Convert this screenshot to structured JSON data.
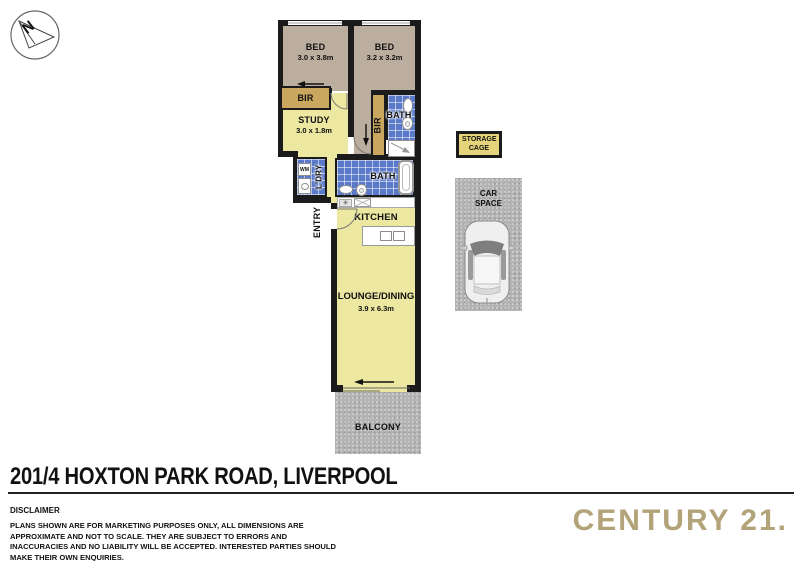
{
  "compass": {
    "north": "N"
  },
  "rooms": {
    "bed1": {
      "name": "BED",
      "dims": "3.0 x 3.8m"
    },
    "bed2": {
      "name": "BED",
      "dims": "3.2 x 3.2m"
    },
    "bir1": {
      "name": "BIR"
    },
    "bir2": {
      "name": "BIR"
    },
    "study": {
      "name": "STUDY",
      "dims": "3.0 x 1.8m"
    },
    "bath1": {
      "name": "BATH"
    },
    "bath2": {
      "name": "BATH"
    },
    "laundry": {
      "name": "L'DRY",
      "washing_machine": "WM"
    },
    "entry": {
      "name": "ENTRY"
    },
    "kitchen": {
      "name": "KITCHEN"
    },
    "lounge": {
      "name": "LOUNGE/DINING",
      "dims": "3.9 x 6.3m"
    },
    "balcony": {
      "name": "BALCONY"
    }
  },
  "external": {
    "storage_cage": "STORAGE CAGE",
    "car_space": "CAR SPACE"
  },
  "footer": {
    "address": "201/4 HOXTON PARK ROAD, LIVERPOOL",
    "disclaimer_heading": "DISCLAIMER",
    "disclaimer_body": "PLANS SHOWN ARE FOR MARKETING PURPOSES ONLY, ALL DIMENSIONS ARE APPROXIMATE AND NOT TO SCALE. THEY ARE SUBJECT TO ERRORS AND INACCURACIES AND NO LIABILITY WILL BE ACCEPTED. INTERESTED PARTIES SHOULD MAKE THEIR OWN ENQUIRIES.",
    "brand": "CENTURY 21."
  },
  "colors": {
    "walls": "#1b1b1b",
    "bedroom_floor": "#bcae9e",
    "living_floor": "#ece8a2",
    "wardrobe_gold": "#c9a75f",
    "bath_tile_blue": "#5b79c9",
    "outdoor_gray": "#b4b4b4",
    "storage_yellow": "#e5d479",
    "brand_gold": "#b3a379"
  }
}
